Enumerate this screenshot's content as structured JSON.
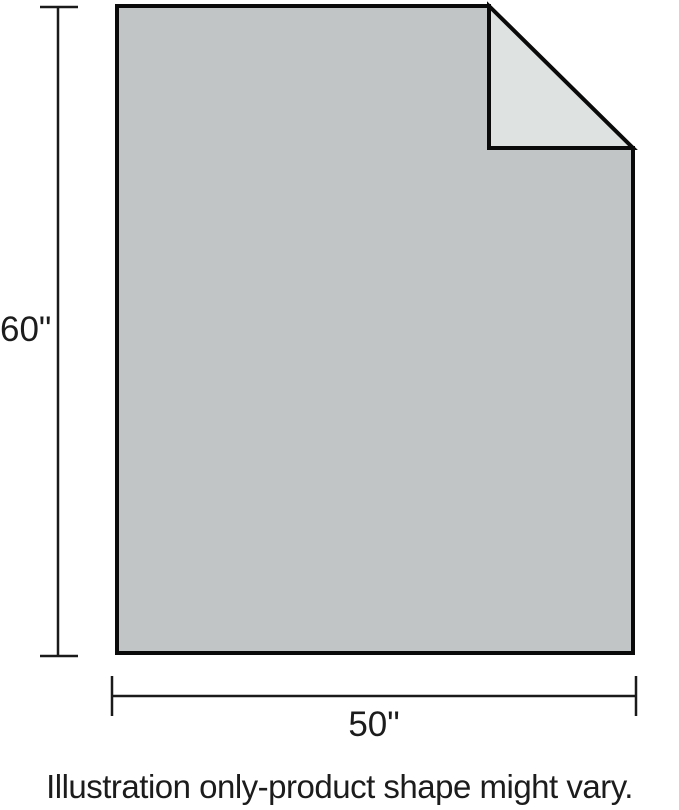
{
  "illustration": {
    "height_label": "60\"",
    "width_label": "50\"",
    "caption": "Illustration only-product shape might vary.",
    "colors": {
      "background": "#ffffff",
      "sheet_fill": "#c1c5c5",
      "fold_fill": "#dee2e1",
      "outline": "#0a0a0a",
      "dimension_line": "#1a1a1a",
      "text": "#1c1c1c"
    },
    "dimensions": {
      "height_inches": 60,
      "width_inches": 50
    }
  }
}
